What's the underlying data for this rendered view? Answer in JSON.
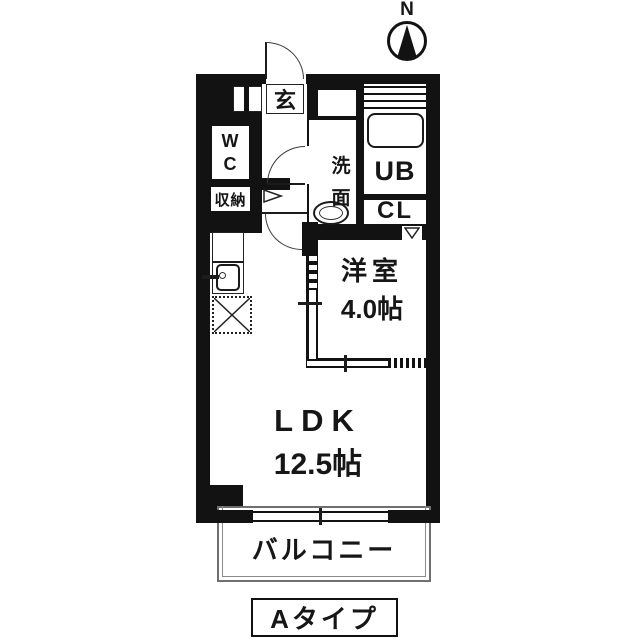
{
  "compass": {
    "north_label": "N"
  },
  "rooms": {
    "entrance": {
      "label": "玄"
    },
    "wc": {
      "label": "WC"
    },
    "storage": {
      "label": "収納"
    },
    "washroom": {
      "label": "洗面"
    },
    "unit_bath": {
      "label": "UB"
    },
    "closet": {
      "label": "CL"
    },
    "western_room": {
      "label": "洋室",
      "size": "4.0帖"
    },
    "ldk": {
      "label": "LDK",
      "size": "12.5帖"
    },
    "balcony": {
      "label": "バルコニー"
    }
  },
  "plan": {
    "type_label": "Aタイプ"
  },
  "colors": {
    "wall": "#121212",
    "line": "#3c3c3c",
    "balcony_border": "#6f6f6f",
    "background": "#ffffff"
  }
}
